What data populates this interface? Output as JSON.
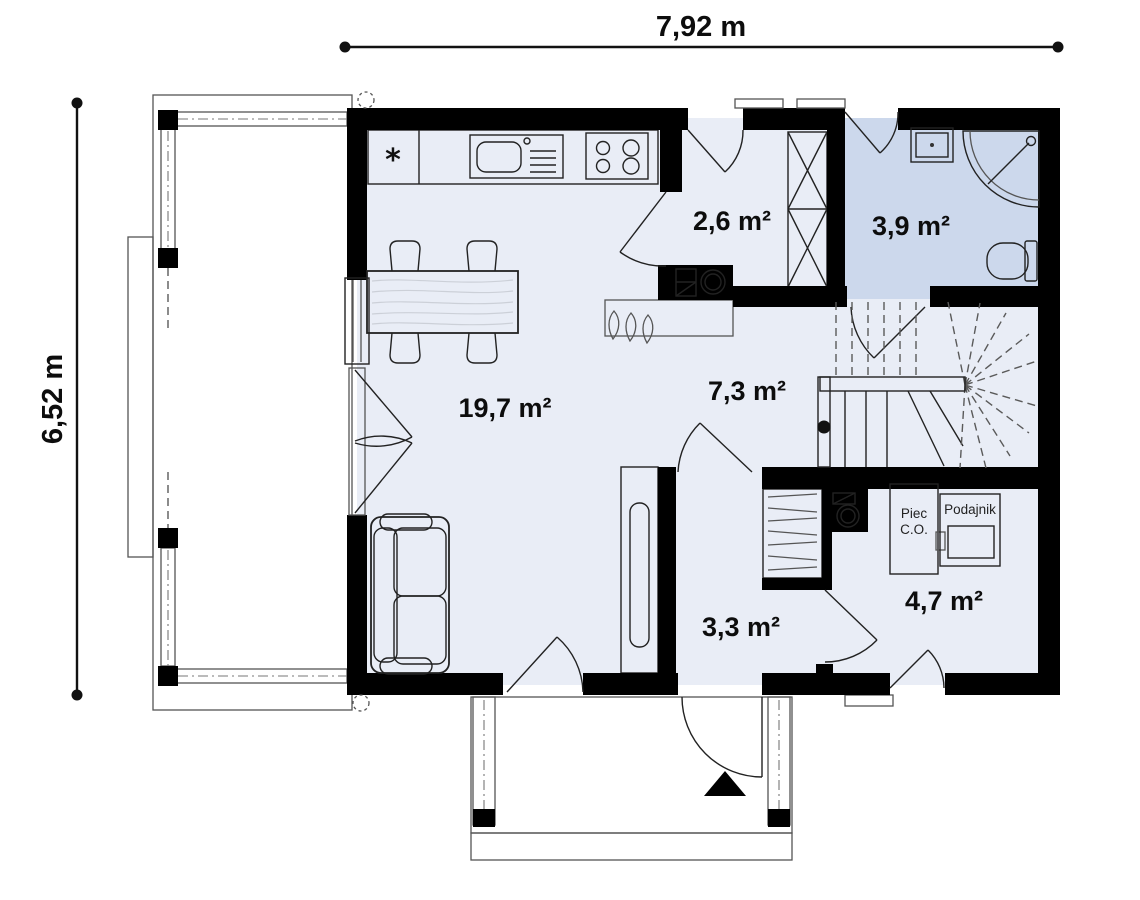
{
  "plan": {
    "type": "house-ground-floor-plan",
    "dimensions": {
      "width_label": "7,92 m",
      "height_label": "6,52 m"
    },
    "rooms": [
      {
        "id": "kitchen-living-room",
        "area_label": "19,7 m²"
      },
      {
        "id": "hall",
        "area_label": "2,6 m²"
      },
      {
        "id": "bathroom",
        "area_label": "3,9 m²"
      },
      {
        "id": "stair-hall",
        "area_label": "7,3 m²"
      },
      {
        "id": "entry-hall",
        "area_label": "3,3 m²"
      },
      {
        "id": "boiler-room",
        "area_label": "4,7 m²"
      }
    ],
    "equipment": {
      "boiler_line1": "Piec",
      "boiler_line2": "C.O.",
      "feeder_label": "Podajnik",
      "kitchen_marker": "*"
    },
    "colors": {
      "wall": "#000000",
      "floor": "#e9edf6",
      "bathroom_floor": "#ccd8ec",
      "sofa": "#d9e3f4",
      "line": "#222222"
    }
  }
}
